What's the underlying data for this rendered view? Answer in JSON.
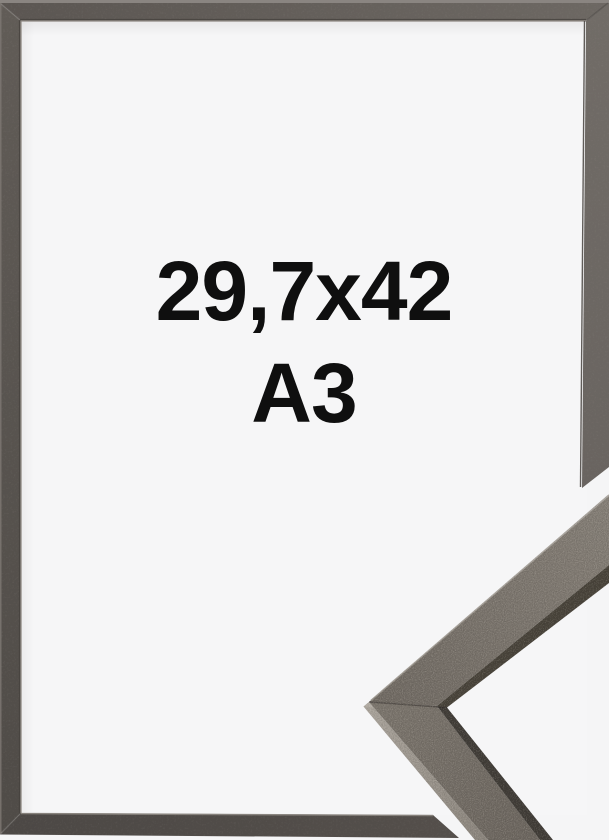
{
  "image": {
    "kind": "picture-frame-product-photo",
    "frame_name": "graphite picture frame",
    "canvas_width": "609",
    "canvas_height": "840"
  },
  "label": {
    "line1": "29,7x42",
    "line2": "A3"
  },
  "colors": {
    "background": "#f5f5f6",
    "paper": "#f6f6f7",
    "text": "#0f0f0f",
    "frame_top": "#5b5652",
    "frame_top_light": "#6d6863",
    "frame_right": "#716c67",
    "frame_right_dark": "#696460",
    "frame_left": "#615c57",
    "frame_left_dark": "#4f4b47",
    "frame_bottom": "#4c4845",
    "frame_bottom_light": "#544f4b",
    "frame_outer_bevel": "#8a8581",
    "frame_inner_bevel_light": "#8f8a84",
    "frame_inner_bevel_dark": "#46423e",
    "detail_face_dark": "#6f6962",
    "detail_face_light": "#847e76",
    "detail_lower_face": "#7b756d",
    "detail_lower_face_dark": "#6c665f",
    "detail_lip": "#474239",
    "detail_lip_dark": "#3f3b36",
    "detail_edge_light": "#a9a39b",
    "detail_edge_mid": "#8b857d",
    "detail_highlight": "#9b958d"
  }
}
